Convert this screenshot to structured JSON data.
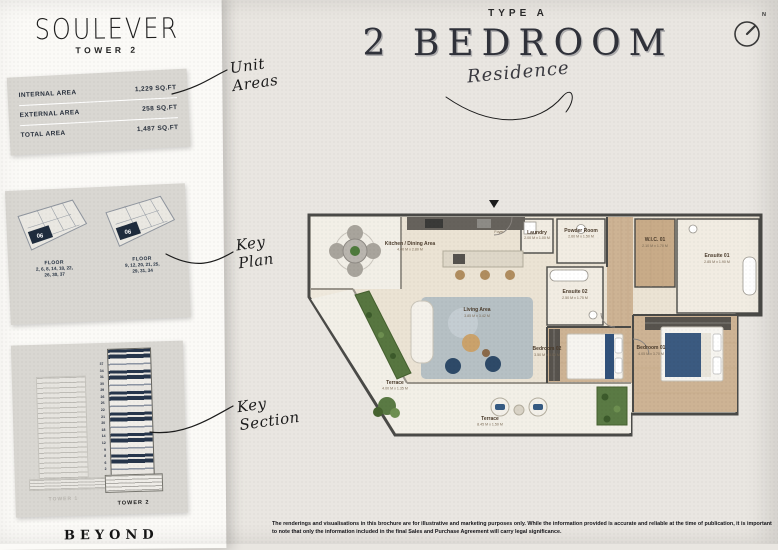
{
  "brand": {
    "logo": "SOULEVER",
    "tower": "TOWER 2",
    "footer": "BEYOND"
  },
  "unit_areas": {
    "rows": [
      {
        "label": "INTERNAL AREA",
        "value": "1,229 SQ.FT"
      },
      {
        "label": "EXTERNAL AREA",
        "value": "258 SQ.FT"
      },
      {
        "label": "TOTAL AREA",
        "value": "1,487 SQ.FT"
      }
    ]
  },
  "key_plan": {
    "plates": [
      {
        "unit": "06",
        "floor_label": "FLOOR",
        "floors": "2, 6, 8, 14, 18, 22,\n26, 30, 37"
      },
      {
        "unit": "06",
        "floor_label": "FLOOR",
        "floors": "9, 12, 20, 21, 25,\n29, 31, 34"
      }
    ]
  },
  "key_section": {
    "towers": [
      {
        "label": "TOWER 1"
      },
      {
        "label": "TOWER 2"
      }
    ],
    "floor_numbers": [
      "2",
      "6",
      "8",
      "9",
      "12",
      "14",
      "18",
      "20",
      "21",
      "22",
      "25",
      "26",
      "29",
      "30",
      "31",
      "34",
      "37"
    ]
  },
  "notes": {
    "unit_areas": "Unit\nAreas",
    "key_plan": "Key\nPlan",
    "key_section": "Key\nSection"
  },
  "header": {
    "type_label": "TYPE A",
    "title": "2 BEDROOM",
    "subtitle": "Residence"
  },
  "compass": {
    "label": "N"
  },
  "floorplan": {
    "rooms": [
      {
        "name": "Kitchen / Dining Area",
        "dims": "4.40 M x 2.80 M"
      },
      {
        "name": "Foyer",
        "dims": ""
      },
      {
        "name": "Laundry",
        "dims": "2.00 M x 1.00 M"
      },
      {
        "name": "Powder Room",
        "dims": "2.60 M x 1.50 M"
      },
      {
        "name": "W.I.C. 01",
        "dims": "2.10 M x 1.70 M"
      },
      {
        "name": "Ensuite 01",
        "dims": "2.85 M x 1.90 M"
      },
      {
        "name": "Ensuite 02",
        "dims": "2.50 M x 1.75 M"
      },
      {
        "name": "Living Area",
        "dims": "3.85 M x 3.42 M"
      },
      {
        "name": "Bedroom 02",
        "dims": "3.50 M x 3.00 M"
      },
      {
        "name": "Bedroom 01",
        "dims": "4.05 M x 3.70 M"
      },
      {
        "name": "Terrace",
        "dims": "4.00 M x 1.35 M"
      },
      {
        "name": "Terrace",
        "dims": "8.45 M x 1.50 M"
      }
    ]
  },
  "disclaimer": "The renderings and visualisations in this brochure are for illustrative and marketing purposes only. While the information provided is accurate and reliable at the time of publication, it is important to note that only the information included in the final Sales and Purchase Agreement will carry legal significance.",
  "colors": {
    "navy": "#1f2c3d",
    "paper": "#e9e6e1",
    "sheet": "#fbfaf7",
    "box": "#d9d7d2"
  }
}
